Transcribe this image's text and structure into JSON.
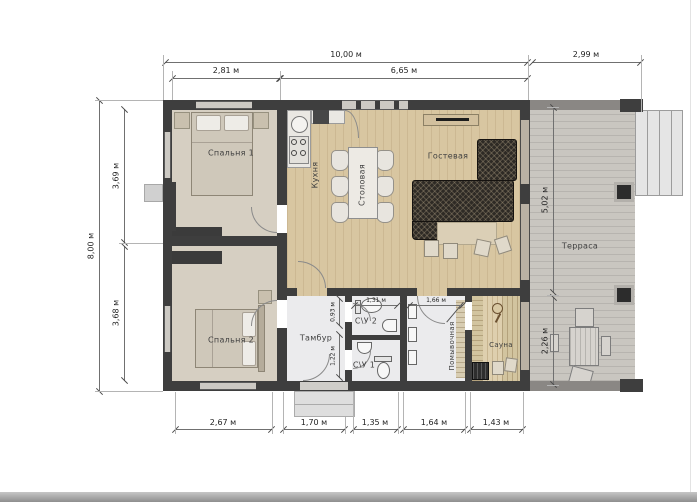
{
  "rooms": {
    "bedroom1": "Спальня 1",
    "bedroom2": "Спальня 2",
    "kitchen": "Кухня",
    "dining": "Столовая",
    "guest": "Гостевая",
    "terrace": "Терраса",
    "tambour": "Тамбур",
    "wc2": "С\\У 2",
    "wc1": "С\\У 1",
    "washroom": "Помывочная",
    "sauna": "Сауна"
  },
  "dims": {
    "top_total": "10,00 м",
    "top_terrace": "2,99 м",
    "top_left": "2,81 м",
    "top_mid": "6,65 м",
    "left_total": "8,00 м",
    "left_upper": "3,69 м",
    "left_lower": "3,68 м",
    "right_upper": "5,02 м",
    "right_lower": "2,26 м",
    "bottom_1": "2,67 м",
    "bottom_2": "1,70 м",
    "bottom_3": "1,35 м",
    "bottom_4": "1,64 м",
    "bottom_5": "1,43 м",
    "wc2_width": "1,31 м",
    "wash_width": "1,66 м",
    "tambour_upper": "0,93 м",
    "tambour_lower": "1,22 м"
  },
  "colors": {
    "wall": "#3e3e3e",
    "wood_floor": "#d8c6a1",
    "terrace_floor": "#c9c6c0",
    "sofa": "#2e2a25"
  }
}
